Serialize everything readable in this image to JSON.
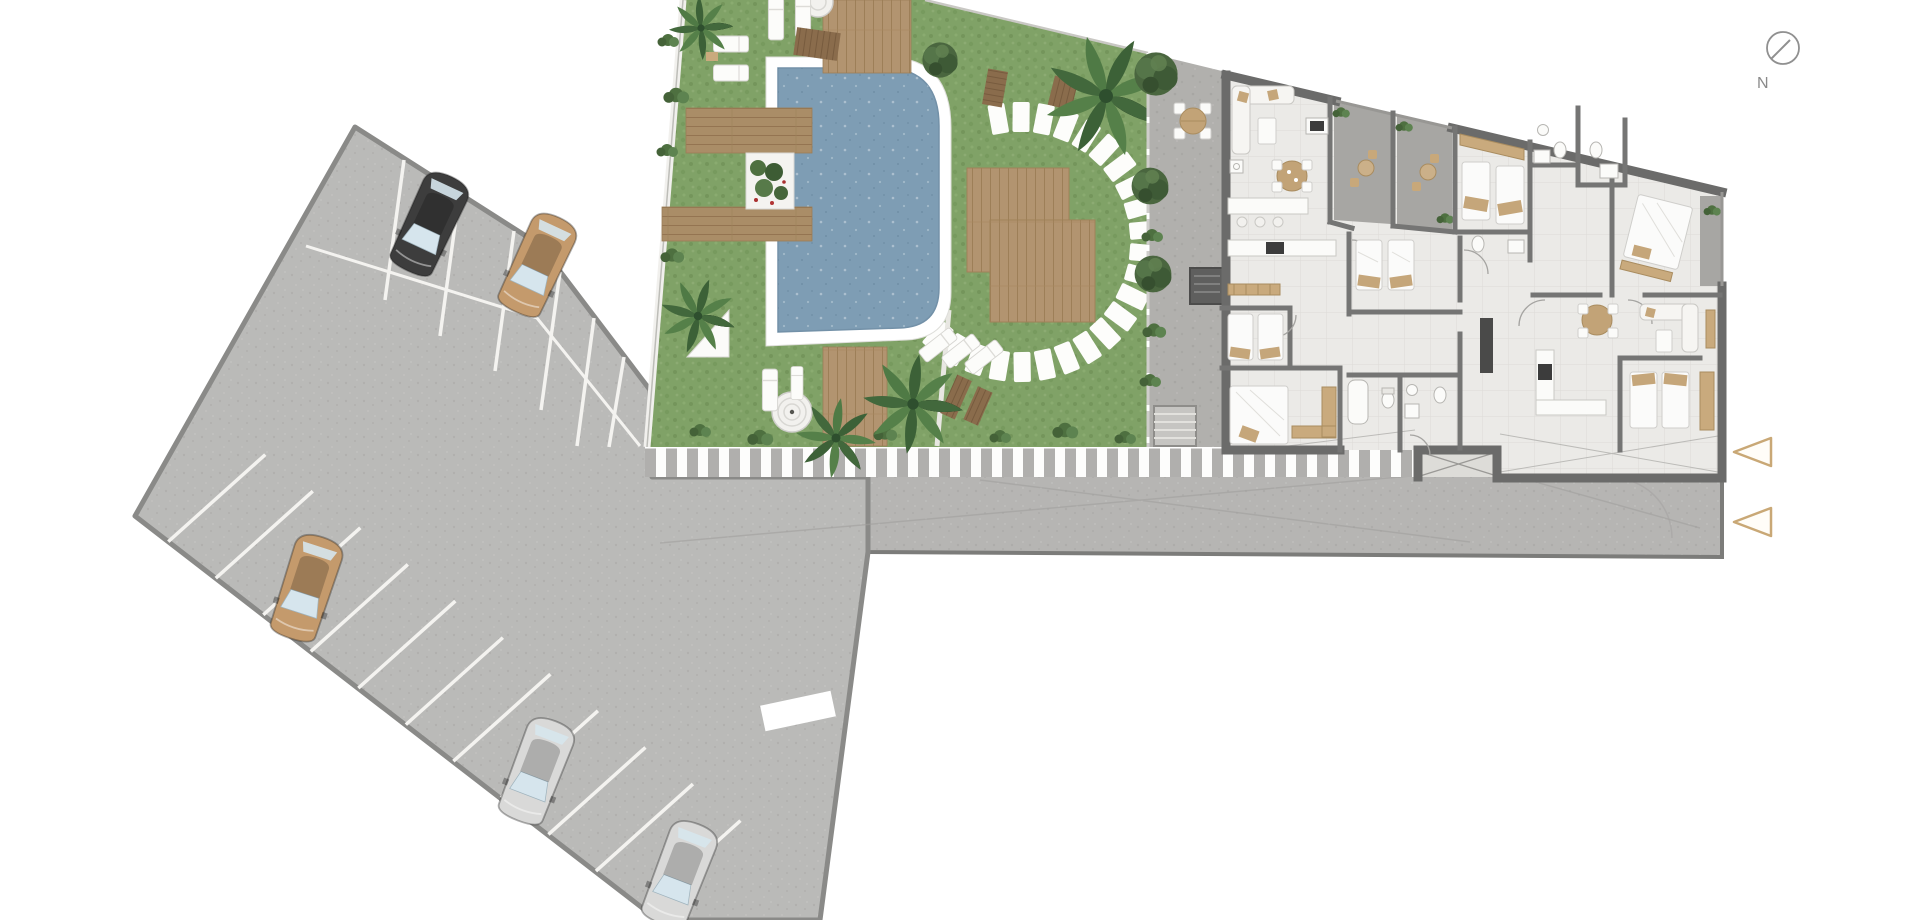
{
  "compass": {
    "label": "N"
  },
  "site": {
    "type": "residential-site-plan",
    "background_color": "#ffffff",
    "colors": {
      "grass": "#81a369",
      "pool_water": "#7e9db4",
      "pool_rim": "#ffffff",
      "wood_deck": "#b29470",
      "wood_dark": "#8a6c4c",
      "road": "#b6b5b3",
      "parking": "#b9b8b6",
      "patio": "#b1b0ad",
      "building_floor": "#ebeae7",
      "wall": "#6b6b6a",
      "stripe_white": "#fdfdfc",
      "accent_tan": "#c9a876"
    }
  },
  "parking": {
    "cars": [
      {
        "id": "car-black-top",
        "color": "#3d3d3d",
        "roof": "rgba(0,0,0,0.25)",
        "location": "top-row"
      },
      {
        "id": "car-tan-top",
        "color": "#c49a6c",
        "roof": "rgba(0,0,0,0.18)",
        "location": "top-row"
      },
      {
        "id": "car-tan-left",
        "color": "#c49a6c",
        "roof": "rgba(0,0,0,0.18)",
        "location": "left-column"
      },
      {
        "id": "car-silver-1",
        "color": "#d9d9d8",
        "roof": "rgba(0,0,0,0.12)",
        "location": "bottom-row"
      },
      {
        "id": "car-silver-2",
        "color": "#d9d9d8",
        "roof": "rgba(0,0,0,0.12)",
        "location": "bottom-row"
      }
    ],
    "occupied_stalls": 5,
    "empty_stalls_visible": 14
  },
  "amenities": {
    "swimming_pool": 1,
    "spiral_fountain": 1,
    "wood_decks": 6,
    "stepping_stones": 25,
    "sun_loungers": 9,
    "picnic_benches": 4,
    "outdoor_dining_sets": 3,
    "palm_trees": 5,
    "trees": 6
  },
  "building": {
    "apartments_visible": 2,
    "terraces": 3,
    "rooms": [
      "living-dining",
      "kitchen",
      "bedroom",
      "bathroom",
      "corridor",
      "stair-core"
    ]
  },
  "markers": {
    "entrance_arrows": {
      "count": 2,
      "color": "#c9a876",
      "fill": "#fffdf8",
      "direction": "left"
    }
  }
}
